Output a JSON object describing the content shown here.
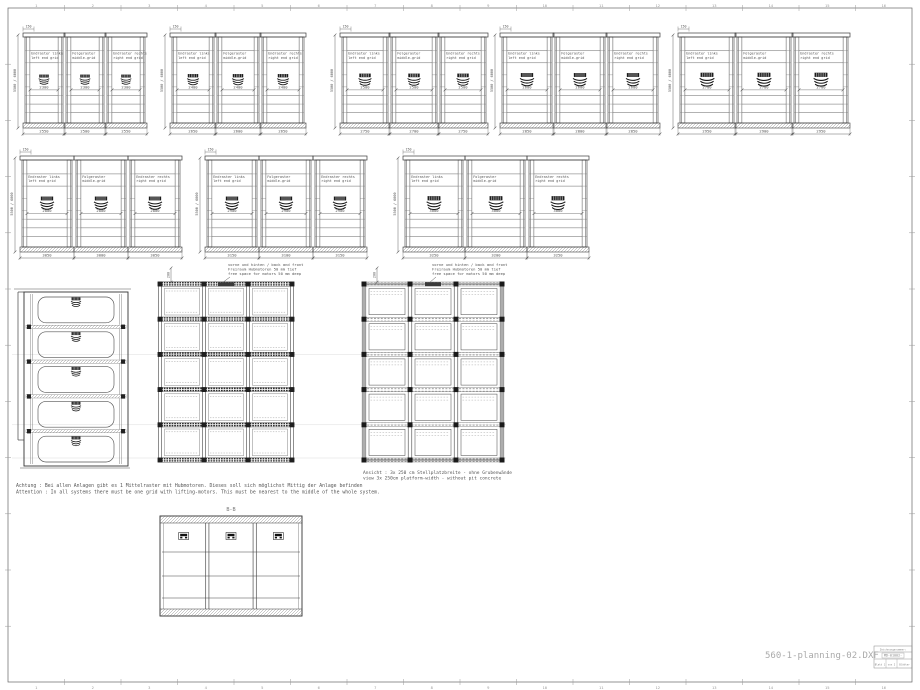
{
  "sheet": {
    "filename": "560-1-planning-02.DXF",
    "zone_numbers": [
      "1",
      "2",
      "3",
      "4",
      "5",
      "6",
      "7",
      "8",
      "9",
      "10",
      "11",
      "12",
      "13",
      "14",
      "15",
      "16"
    ],
    "title_block": {
      "label": "Zeichnungsnummer:",
      "number": "MD-01002-",
      "row": [
        "Blatt 1",
        "von 2",
        "Blätter"
      ]
    }
  },
  "panel_labels": [
    [
      "Endraster links",
      "left end grid"
    ],
    [
      "Folgeraster",
      "middle-grid"
    ],
    [
      "Endraster rechts",
      "right end grid"
    ]
  ],
  "elevation_rows": [
    {
      "height_dim": "5500 / 6000",
      "top_dim": "150",
      "groups": [
        {
          "platform": "2300",
          "bottom_dims": [
            "2550",
            "2500",
            "2550"
          ]
        },
        {
          "platform": "2400",
          "bottom_dims": [
            "2650",
            "2600",
            "2650"
          ]
        },
        {
          "platform": "2500",
          "bottom_dims": [
            "2750",
            "2700",
            "2750"
          ]
        },
        {
          "platform": "2600",
          "bottom_dims": [
            "2850",
            "2800",
            "2850"
          ]
        },
        {
          "platform": "2700",
          "bottom_dims": [
            "2950",
            "2900",
            "2950"
          ]
        }
      ]
    },
    {
      "height_dim": "5500 / 6000",
      "top_dim": "150",
      "groups": [
        {
          "platform": "2800",
          "bottom_dims": [
            "3050",
            "3000",
            "3050"
          ]
        },
        {
          "platform": "2900",
          "bottom_dims": [
            "3150",
            "3100",
            "3150"
          ]
        },
        {
          "platform": "3000",
          "bottom_dims": [
            "3250",
            "3200",
            "3250"
          ]
        }
      ]
    }
  ],
  "plan_views": {
    "motor_note": [
      "vorne und hinten / back and front",
      "Freiraum Hubmotoren 50 mm tief",
      "free space for motors  50 mm deep"
    ],
    "depth_dim": "200",
    "left_plan": {
      "spots": 5
    },
    "grid_plan": {
      "cols": 3,
      "rows": 5
    },
    "open_plan": {
      "cols": 3,
      "rows": 5
    },
    "caption": [
      "Ansicht : 3x 250 cm Stellplatzbreite - ohne Grubenwände",
      "view 3x 250cm platform-width  - without pit concrete"
    ]
  },
  "section": {
    "label": "B-B",
    "bays": 3,
    "levels": 4
  },
  "attention_note": [
    "Achtung :  Bei allen Anlagen gibt es  1  Mittelraster mit Hubmotoren. Dieses soll sich möglichst Mittig der Anlage befinden",
    "Attention :  In all systems there must be one grid with lifting-motors. This must be nearest to the middle of the whole system."
  ]
}
